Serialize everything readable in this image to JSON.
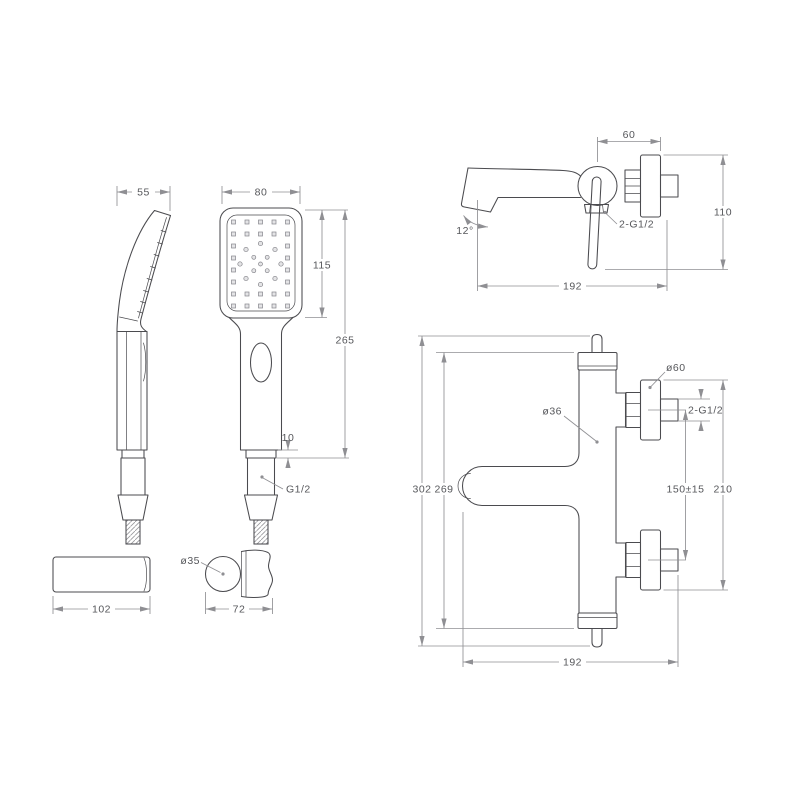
{
  "colors": {
    "object_line": "#4b4b4f",
    "dimension_line": "#8f8f93",
    "label_text": "#56575b",
    "hatch_line": "#97979b",
    "background": "#ffffff"
  },
  "dimensions": {
    "hand_shower_side": {
      "head_depth": "55"
    },
    "hand_shower_front": {
      "head_width": "80",
      "head_height": "115",
      "total_length": "265",
      "collar_height": "10",
      "hose_thread": "G1/2"
    },
    "bath_mixer_side": {
      "wall_offset": "60",
      "body_height": "110",
      "spout_reach": "192",
      "spout_angle": "12°",
      "connection_thread": "2-G1/2"
    },
    "bracket_bar": {
      "length": "102"
    },
    "shower_holder": {
      "diameter": "ø35",
      "depth": "72"
    },
    "thermostatic_mixer_front": {
      "overall_height": "302",
      "body_height": "269",
      "body_diameter": "ø36",
      "escutcheon_diameter": "ø60",
      "connection_thread": "2-G1/2",
      "inlet_spacing": "150±15",
      "escutcheon_span": "210",
      "spout_reach": "192"
    }
  }
}
